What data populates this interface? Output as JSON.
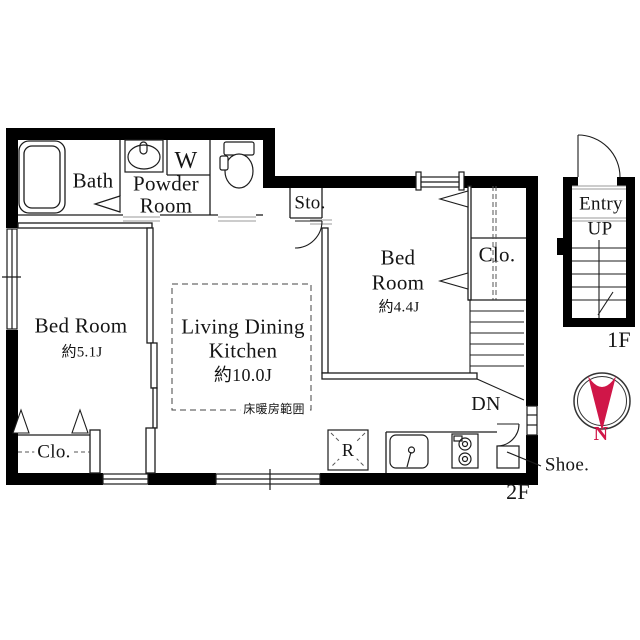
{
  "rooms": {
    "bath": {
      "label": "Bath"
    },
    "powder": {
      "line1": "Powder",
      "line2": "Room"
    },
    "washer": {
      "label": "W"
    },
    "storage": {
      "label": "Sto."
    },
    "bedroom_51": {
      "line1": "Bed Room",
      "size": "約5.1J"
    },
    "bedroom_44": {
      "line1": "Bed",
      "line2": "Room",
      "size": "約4.4J"
    },
    "closet_44": {
      "label": "Clo."
    },
    "closet_51": {
      "label": "Clo."
    },
    "ldk": {
      "line1": "Living Dining",
      "line2": "Kitchen",
      "size": "約10.0J",
      "heating_note": "床暖房範囲"
    }
  },
  "kitchen": {
    "refrigerator": "R"
  },
  "stairs": {
    "down": "DN"
  },
  "entry_2f": {
    "shoe": "Shoe."
  },
  "entry_1f": {
    "entry": "Entry",
    "up": "UP"
  },
  "floors": {
    "current": "2F",
    "entry": "1F"
  },
  "compass": {
    "label": "N",
    "color": "#d01648"
  },
  "colors": {
    "wall": "#000000",
    "line": "#1c1c1c",
    "threshold": "#999999",
    "accent": "#d01648"
  }
}
